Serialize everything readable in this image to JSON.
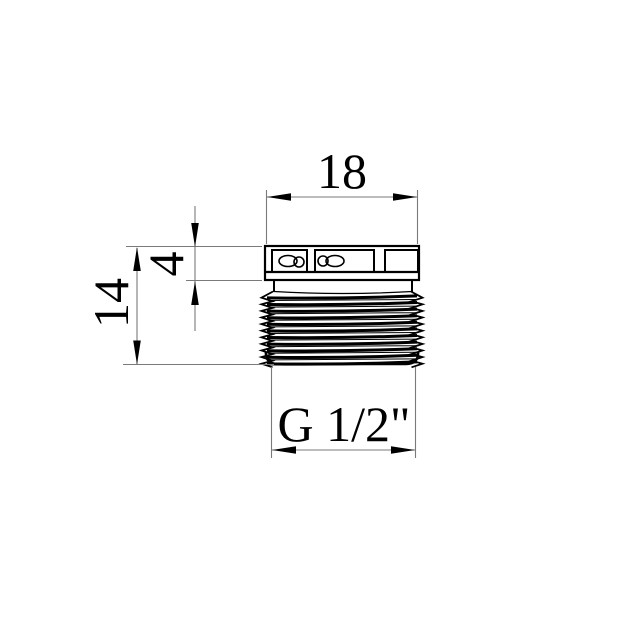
{
  "colors": {
    "background": "#ffffff",
    "object_line": "#000000",
    "thin_line": "#7a7a7a",
    "text": "#000000"
  },
  "dimensions": {
    "top_width": {
      "label": "18"
    },
    "head_height": {
      "label": "4"
    },
    "overall_height": {
      "label": "14"
    },
    "thread_size": {
      "label": "G 1/2\""
    }
  }
}
